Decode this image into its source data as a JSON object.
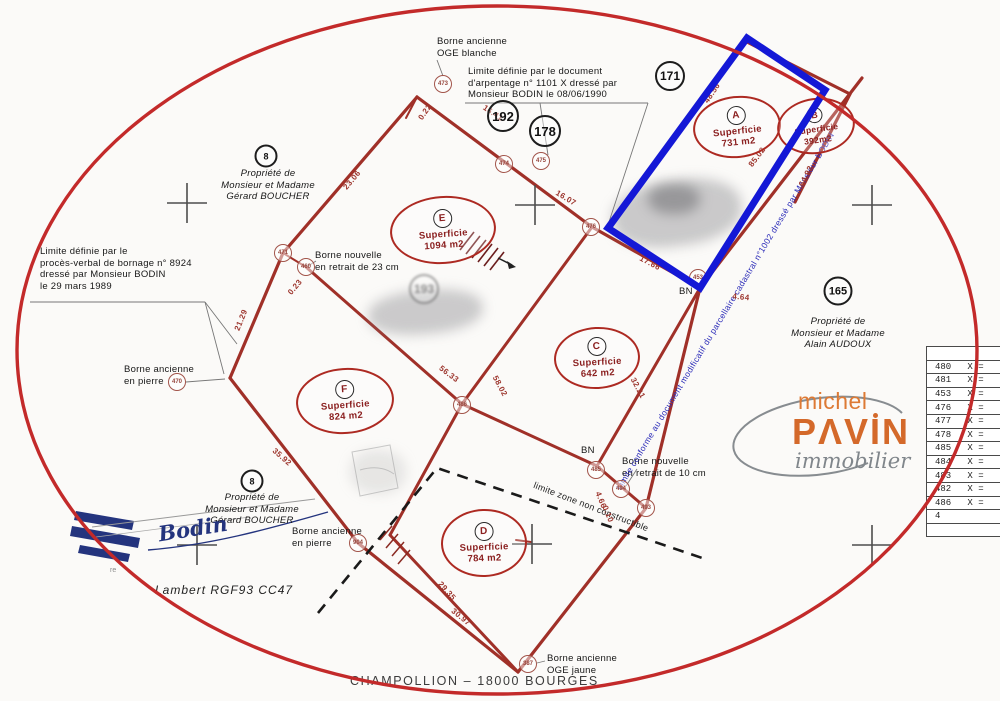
{
  "notes": {
    "borne_blanche": "Borne ancienne\nOGE blanche",
    "arpentage": "Limite définie par le document\nd'arpentage n° 1101 X dressé par\nMonsieur BODIN le 08/06/1990",
    "prop_boucher": "Propriété de\nMonsieur et Madame\nGérard BOUCHER",
    "pv_bornage": "Limite définie par le\nprocès-verbal de bornage n° 8924\ndressé par Monsieur BODIN\nle 29 mars 1989",
    "borne_nouvelle_23": "Borne nouvelle\nen retrait de 23 cm",
    "borne_pierre": "Borne ancienne\nen pierre",
    "prop_audoux": "Propriété de\nMonsieur et Madame\nAlain AUDOUX",
    "borne_nouvelle_10": "Borne nouvelle\nen retrait de 10 cm",
    "bn": "BN",
    "limite_zone": "limite zone non constructible",
    "borne_oge_jaune": "Borne ancienne\nOGE jaune",
    "limite_conforme": "Limite conforme au document modificatif du parcellaire cadastral n°1002 dressé par Monsieur BODIN",
    "lambert": "Lambert RGF93 CC47",
    "signature_fragment": "re"
  },
  "parcels": {
    "A": {
      "letter": "A",
      "label": "Superficie",
      "area": "731 m2"
    },
    "B": {
      "letter": "B",
      "label": "Superficie",
      "area": "392m2"
    },
    "E": {
      "letter": "E",
      "label": "Superficie",
      "area": "1094 m2"
    },
    "C": {
      "letter": "C",
      "label": "Superficie",
      "area": "642 m2"
    },
    "F": {
      "letter": "F",
      "label": "Superficie",
      "area": "824 m2"
    },
    "D": {
      "letter": "D",
      "label": "Superficie",
      "area": "784 m2"
    }
  },
  "refs": [
    {
      "v": "171"
    },
    {
      "v": "192"
    },
    {
      "v": "178"
    },
    {
      "v": "8"
    },
    {
      "v": "165"
    },
    {
      "v": "8"
    },
    {
      "v": "193"
    }
  ],
  "points": [
    {
      "v": "473"
    },
    {
      "v": "474"
    },
    {
      "v": "475"
    },
    {
      "v": "476"
    },
    {
      "v": "453"
    },
    {
      "v": "471"
    },
    {
      "v": "460"
    },
    {
      "v": "470"
    },
    {
      "v": "486"
    },
    {
      "v": "485"
    },
    {
      "v": "494"
    },
    {
      "v": "493"
    },
    {
      "v": "904"
    },
    {
      "v": "387"
    }
  ],
  "measurements": [
    {
      "v": "0.22"
    },
    {
      "v": "16.41"
    },
    {
      "v": "16.07"
    },
    {
      "v": "23.06"
    },
    {
      "v": "48.56"
    },
    {
      "v": "17.66"
    },
    {
      "v": "85.02"
    },
    {
      "v": "4.64"
    },
    {
      "v": "64.92"
    },
    {
      "v": "21.29"
    },
    {
      "v": "0.23"
    },
    {
      "v": "35.92"
    },
    {
      "v": "56.33"
    },
    {
      "v": "58.02"
    },
    {
      "v": "32.21"
    },
    {
      "v": "29.35"
    },
    {
      "v": "30.97"
    },
    {
      "v": "4.66"
    },
    {
      "v": "0.10"
    }
  ],
  "table": {
    "rows": [
      "",
      "480   X =",
      "481   X =",
      "453   X =",
      "476   X =",
      "477   X =",
      "478   X =",
      "485   X =",
      "484   X =",
      "483   X =",
      "482   X =",
      "486   X =",
      "4",
      ""
    ]
  },
  "logo": {
    "top": "michel",
    "main": "PΛVIN",
    "sub": "immobilier"
  },
  "signature": {
    "name": "Bodin"
  },
  "footer": "CHAMPOLLION  –  18000 BOURGES"
}
